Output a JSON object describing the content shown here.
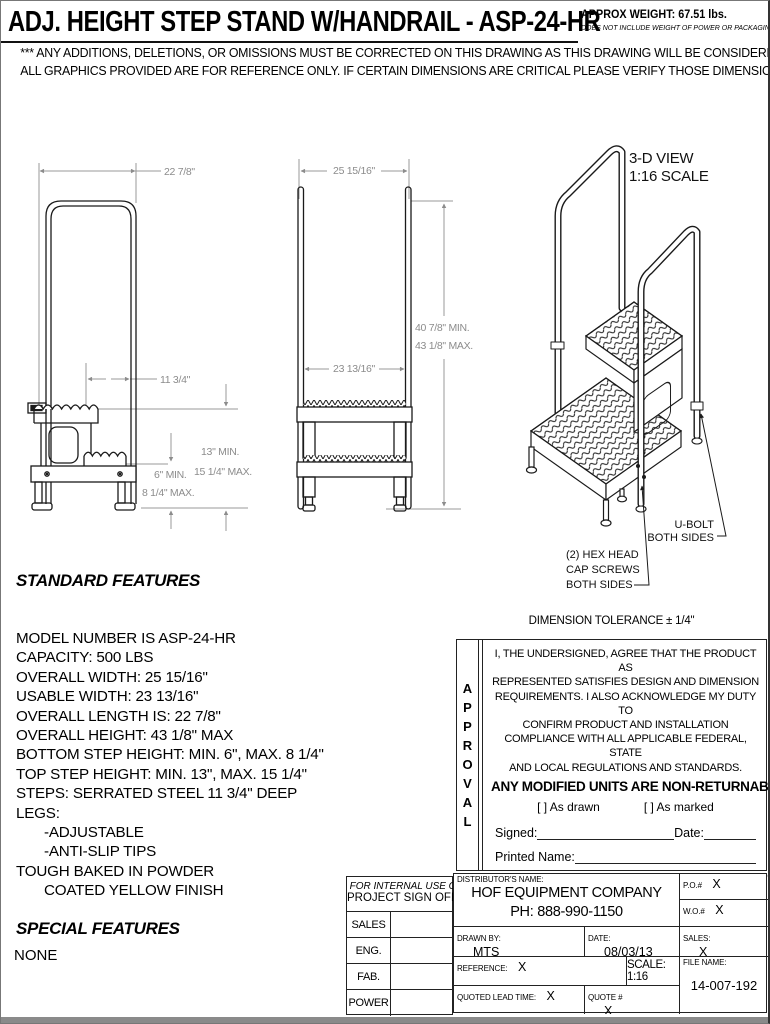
{
  "header": {
    "title": "ADJ. HEIGHT STEP STAND W/HANDRAIL - ASP-24-HR",
    "approx_weight": "APPROX WEIGHT: 67.51 lbs.",
    "weight_note": "DOES NOT INCLUDE WEIGHT OF POWER OR PACKAGING!!!",
    "disclaimer_line1": "*** ANY ADDITIONS, DELETIONS, OR OMISSIONS MUST BE CORRECTED ON THIS DRAWING AS THIS DRAWING WILL BE CONSIDERED ALL INCLUSIVE ***",
    "disclaimer_line2": "ALL GRAPHICS PROVIDED ARE FOR REFERENCE ONLY. IF CERTAIN DIMENSIONS ARE CRITICAL PLEASE VERIFY THOSE DIMENSIONS WITH YOUR SALESPERSON"
  },
  "side_view": {
    "dim_overall_length": "22 7/8\"",
    "dim_step_depth": "11 3/4\"",
    "dim_top_step_min": "13\" MIN.",
    "dim_top_step_max": "15 1/4\" MAX.",
    "dim_bottom_step_min": "6\" MIN.",
    "dim_bottom_step_max": "8 1/4\" MAX."
  },
  "front_view": {
    "dim_overall_width": "25 15/16\"",
    "dim_usable_width": "23 13/16\"",
    "dim_height_min": "40 7/8\" MIN.",
    "dim_height_max": "43 1/8\" MAX."
  },
  "iso_view": {
    "label_line1": "3-D VIEW",
    "label_line2": "1:16 SCALE",
    "ubolt_line1": "U-BOLT",
    "ubolt_line2": "BOTH SIDES",
    "hex_line1": "(2) HEX HEAD",
    "hex_line2": "CAP SCREWS",
    "hex_line3": "BOTH SIDES"
  },
  "standard_features": {
    "heading": "STANDARD FEATURES",
    "items": [
      "MODEL NUMBER IS ASP-24-HR",
      "CAPACITY: 500 LBS",
      "OVERALL WIDTH: 25 15/16\"",
      "USABLE WIDTH: 23 13/16\"",
      "OVERALL LENGTH IS: 22 7/8\"",
      "OVERALL HEIGHT: 43 1/8\" MAX",
      "BOTTOM STEP HEIGHT: MIN. 6\", MAX. 8 1/4\"",
      "TOP STEP HEIGHT: MIN. 13\", MAX. 15 1/4\"",
      "STEPS: SERRATED STEEL 11 3/4\" DEEP",
      "LEGS:",
      "-ADJUSTABLE",
      "-ANTI-SLIP TIPS",
      "TOUGH BAKED IN POWDER",
      "COATED YELLOW FINISH"
    ]
  },
  "special_features": {
    "heading": "SPECIAL FEATURES",
    "value": "NONE"
  },
  "approval": {
    "tolerance": "DIMENSION TOLERANCE ± 1/4\"",
    "vertical_label": "APPROVAL",
    "statement_lines": [
      "I, THE UNDERSIGNED, AGREE THAT THE PRODUCT AS",
      "REPRESENTED SATISFIES DESIGN AND DIMENSION",
      "REQUIREMENTS.  I ALSO ACKNOWLEDGE MY DUTY TO",
      "CONFIRM PRODUCT AND INSTALLATION",
      "COMPLIANCE WITH ALL APPLICABLE FEDERAL, STATE",
      "AND LOCAL REGULATIONS AND STANDARDS."
    ],
    "non_returnable": "ANY MODIFIED UNITS ARE NON-RETURNABLE",
    "as_drawn": "[  ] As drawn",
    "as_marked": "[  ] As marked",
    "signed_label": "Signed:",
    "date_label": "Date:",
    "printed_name_label": "Printed Name:",
    "lead_time_note": "LEAD TIME WILL START UPON RECEIPT OF SIGNED APPROVAL DRAWING"
  },
  "internal_use": {
    "header_line1": "FOR INTERNAL USE ONLY",
    "header_line2": "PROJECT SIGN OFF",
    "rows": [
      "SALES",
      "ENG.",
      "FAB.",
      "POWER"
    ]
  },
  "title_block": {
    "distributor_label": "DISTRIBUTOR'S NAME:",
    "distributor_name": "HOF EQUIPMENT COMPANY",
    "distributor_phone": "PH: 888-990-1150",
    "po_label": "P.O.#",
    "po_value": "X",
    "wo_label": "W.O.#",
    "wo_value": "X",
    "drawn_by_label": "DRAWN BY:",
    "drawn_by_value": "MTS",
    "date_label": "DATE:",
    "date_value": "08/03/13",
    "sales_label": "SALES:",
    "sales_value": "X",
    "reference_label": "REFERENCE:",
    "reference_value": "X",
    "scale_label": "SCALE: 1:16",
    "file_name_label": "FILE NAME:",
    "file_name_value": "14-007-192",
    "quoted_lead_label": "QUOTED LEAD TIME:",
    "quoted_lead_value": "X",
    "quote_label": "QUOTE #",
    "quote_value": "X"
  },
  "colors": {
    "line": "#1a1a1a",
    "dimension": "#8c8c8c",
    "paper": "#ffffff"
  }
}
